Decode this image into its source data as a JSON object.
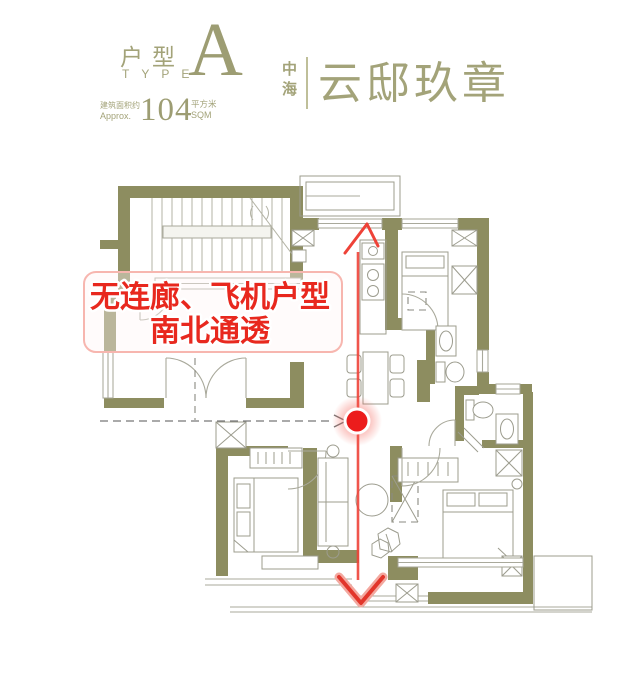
{
  "header": {
    "type_label_cn": "户型",
    "type_label_en": "TYPE",
    "type_value": "A",
    "area_label_cn": "建筑面积约",
    "area_label_en": "Approx.",
    "area_value": "104",
    "area_unit_cn": "平方米",
    "area_unit_en": "SQM",
    "brand_char_1": "中",
    "brand_char_2": "海",
    "brand_name": "云邸玖章"
  },
  "annotation": {
    "line1": "无连廊、飞机户型",
    "line2": "南北通透"
  },
  "colors": {
    "brand_green": "#A3A379",
    "wall_olive": "#8D8D60",
    "accent_red": "#E8281E"
  }
}
